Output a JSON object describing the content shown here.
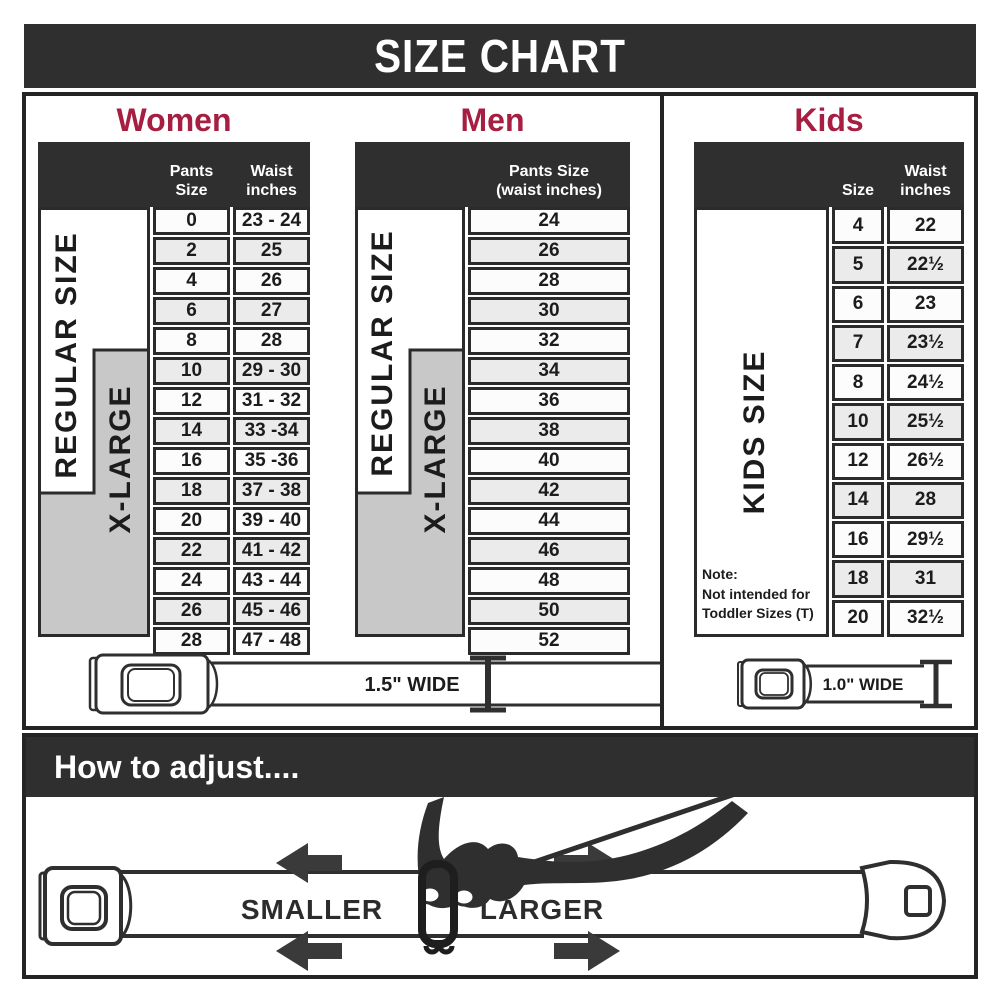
{
  "title": "SIZE CHART",
  "colors": {
    "accent_red": "#a61e41",
    "dark": "#2f2f2f",
    "stripe_gray": "#ebebeb",
    "xlarge_gray": "#c8c8c8"
  },
  "sections": {
    "women": {
      "heading": "Women",
      "col2_header": "Pants Size",
      "col3_header": [
        "Waist",
        "inches"
      ],
      "regular_label": "REGULAR SIZE",
      "xlarge_label": "X-LARGE",
      "belt_width": "1.5\" WIDE"
    },
    "men": {
      "heading": "Men",
      "col_header": [
        "Pants Size",
        "(waist inches)"
      ],
      "regular_label": "REGULAR SIZE",
      "xlarge_label": "X-LARGE"
    },
    "kids": {
      "heading": "Kids",
      "col2_header": "Size",
      "col3_header": [
        "Waist",
        "inches"
      ],
      "side_label": "KIDS SIZE",
      "note": [
        "Note:",
        "Not intended for",
        "Toddler Sizes (T)"
      ],
      "belt_width": "1.0\" WIDE"
    }
  },
  "adjust": {
    "heading": "How to adjust....",
    "smaller_label": "SMALLER",
    "larger_label": "LARGER"
  },
  "chart_data": [
    {
      "type": "table",
      "title": "Women",
      "columns": [
        "Pants Size",
        "Waist inches"
      ],
      "rows": [
        [
          "0",
          "23 - 24"
        ],
        [
          "2",
          "25"
        ],
        [
          "4",
          "26"
        ],
        [
          "6",
          "27"
        ],
        [
          "8",
          "28"
        ],
        [
          "10",
          "29 - 30"
        ],
        [
          "12",
          "31 - 32"
        ],
        [
          "14",
          "33 -34"
        ],
        [
          "16",
          "35 -36"
        ],
        [
          "18",
          "37 - 38"
        ],
        [
          "20",
          "39 - 40"
        ],
        [
          "22",
          "41 - 42"
        ],
        [
          "24",
          "43 - 44"
        ],
        [
          "26",
          "45 - 46"
        ],
        [
          "28",
          "47 - 48"
        ]
      ],
      "size_ranges": {
        "REGULAR SIZE": "0 - 18",
        "X-LARGE": "10 - 28"
      },
      "belt_width": "1.5\" WIDE"
    },
    {
      "type": "table",
      "title": "Men",
      "columns": [
        "Pants Size (waist inches)"
      ],
      "rows": [
        "24",
        "26",
        "28",
        "30",
        "32",
        "34",
        "36",
        "38",
        "40",
        "42",
        "44",
        "46",
        "48",
        "50",
        "52"
      ],
      "size_ranges": {
        "REGULAR SIZE": "24 - 42",
        "X-LARGE": "34 - 52"
      }
    },
    {
      "type": "table",
      "title": "Kids",
      "columns": [
        "Size",
        "Waist inches"
      ],
      "rows": [
        [
          "4",
          "22"
        ],
        [
          "5",
          "22½"
        ],
        [
          "6",
          "23"
        ],
        [
          "7",
          "23½"
        ],
        [
          "8",
          "24½"
        ],
        [
          "10",
          "25½"
        ],
        [
          "12",
          "26½"
        ],
        [
          "14",
          "28"
        ],
        [
          "16",
          "29½"
        ],
        [
          "18",
          "31"
        ],
        [
          "20",
          "32½"
        ]
      ],
      "size_ranges": {
        "KIDS SIZE": "4 - 20"
      },
      "note": "Note: Not intended for Toddler Sizes (T)",
      "belt_width": "1.0\" WIDE"
    }
  ]
}
